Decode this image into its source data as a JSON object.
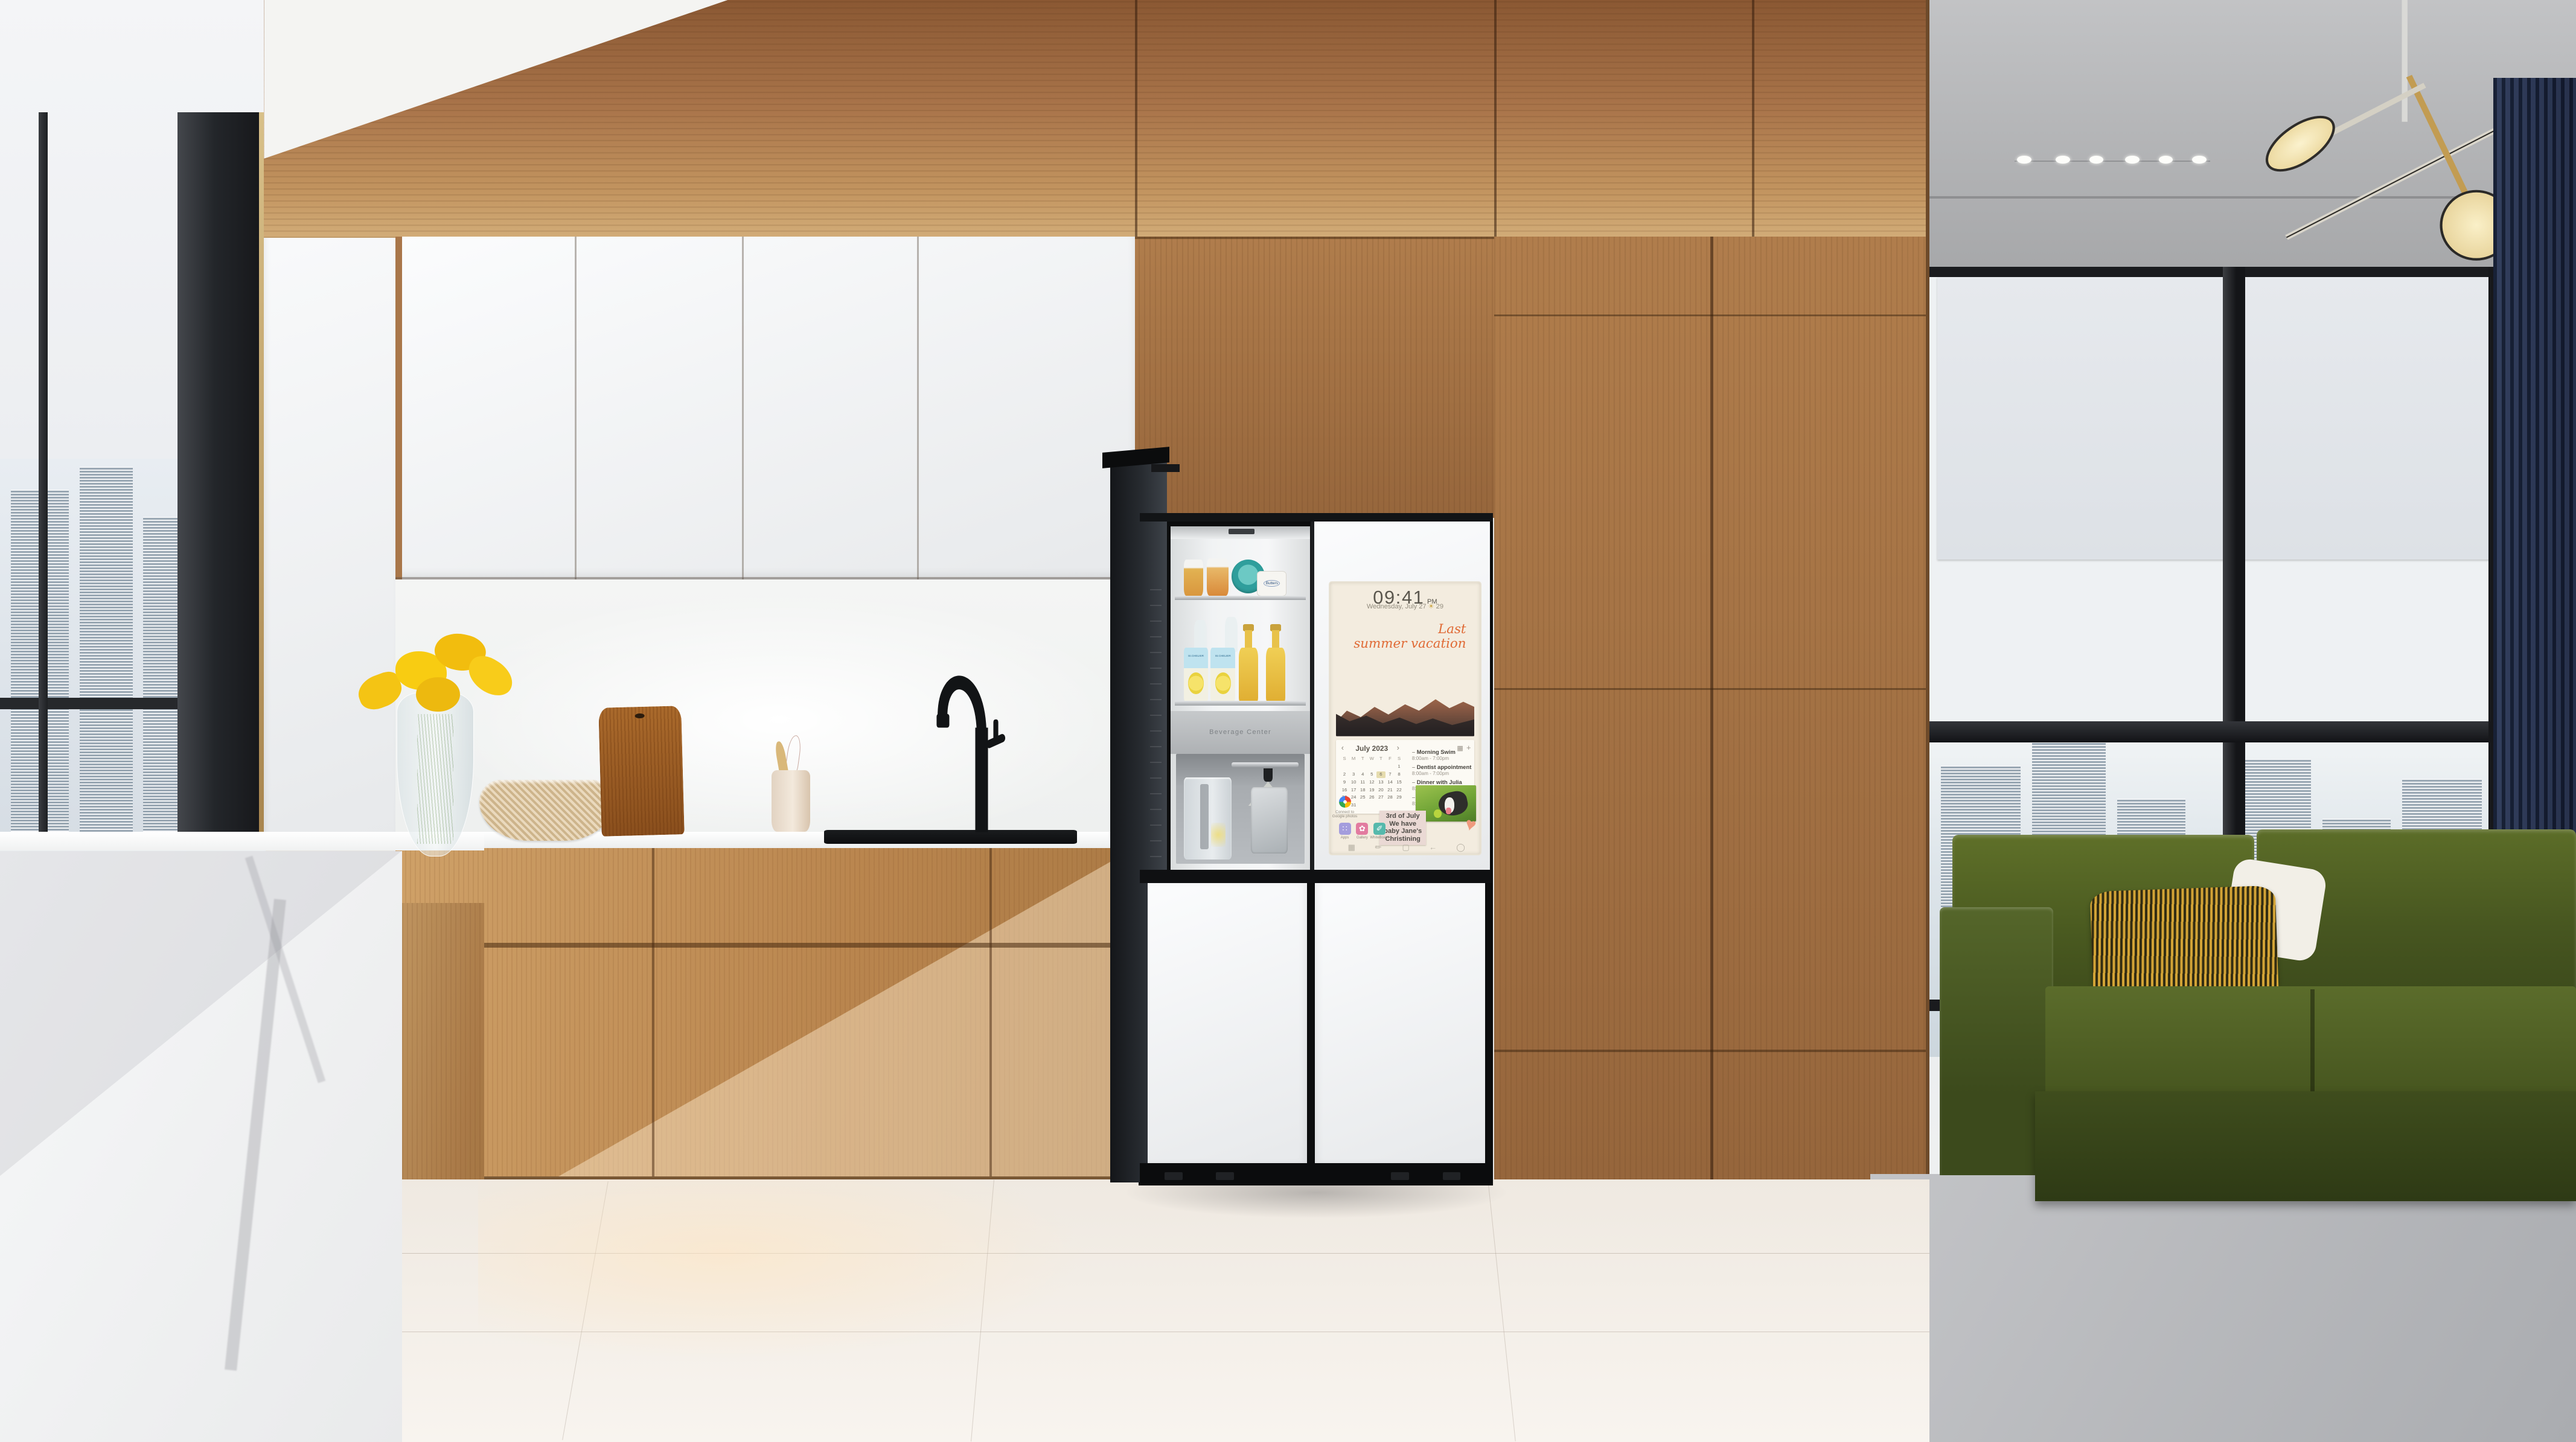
{
  "colors": {
    "wood": "#a9774a",
    "wood_light": "#c79a63",
    "cabinet_white": "#f4f5f6",
    "marble_white": "#f5f6f7",
    "sofa_green": "#4d5c22",
    "pillow_gold": "#c9992f",
    "curtain_navy": "#1d2942",
    "screen_cream": "#f3ecdf",
    "caption_orange": "#e0703a",
    "cheese_teal": "#2f9e9c",
    "flower_yellow": "#f4c414"
  },
  "icons": {
    "weather": "☀",
    "calendar_prev": "‹",
    "calendar_next": "›",
    "calendar_view": "▦",
    "calendar_add": "+",
    "event_bullet": "–",
    "heart_sticker": "♥",
    "apps_glyph": "∷",
    "gallery_glyph": "✿",
    "whiteboard_glyph": "✐",
    "nav": [
      "▦",
      "✏",
      "▢",
      "←",
      "◯"
    ]
  },
  "fridge": {
    "beverage_center_label": "Beverage Center",
    "shelf_items": {
      "butter_tub": "Butters",
      "drink_label": "St.CHELIER"
    },
    "screen": {
      "time": "09:41",
      "period": "PM",
      "date": "Wednesday, July 27",
      "weather_temp": "29",
      "photo_caption": {
        "line1": "Last",
        "line2": "summer vacation"
      },
      "calendar": {
        "title": "July 2023",
        "weekdays": [
          "S",
          "M",
          "T",
          "W",
          "T",
          "F",
          "S"
        ],
        "weeks": [
          [
            "",
            "",
            "",
            "",
            "",
            "",
            "1"
          ],
          [
            "2",
            "3",
            "4",
            "5",
            "6",
            "7",
            "8"
          ],
          [
            "9",
            "10",
            "11",
            "12",
            "13",
            "14",
            "15"
          ],
          [
            "16",
            "17",
            "18",
            "19",
            "20",
            "21",
            "22"
          ],
          [
            "23",
            "24",
            "25",
            "26",
            "27",
            "28",
            "29"
          ],
          [
            "30",
            "31",
            "",
            "",
            "",
            "",
            ""
          ]
        ],
        "highlighted_day": "6"
      },
      "events": [
        {
          "title": "Morning Swim",
          "time": "8:00am - 7:00pm"
        },
        {
          "title": "Dentist appointment",
          "time": "8:00am - 7:00pm"
        },
        {
          "title": "Dinner with Julia",
          "time": "8:00am - 7:00pm"
        },
        {
          "title": "Dentist appointment",
          "time": "8:00am - 7:00pm"
        }
      ],
      "note": {
        "line1": "3rd of July",
        "line2": "We have",
        "line3": "baby Jane's",
        "line4": "Christining"
      },
      "google_photos": {
        "line1": "Connect to",
        "line2": "Google photos"
      },
      "apps": [
        {
          "label": "Apps"
        },
        {
          "label": "Gallery"
        },
        {
          "label": "WhiteBoard"
        }
      ]
    }
  }
}
